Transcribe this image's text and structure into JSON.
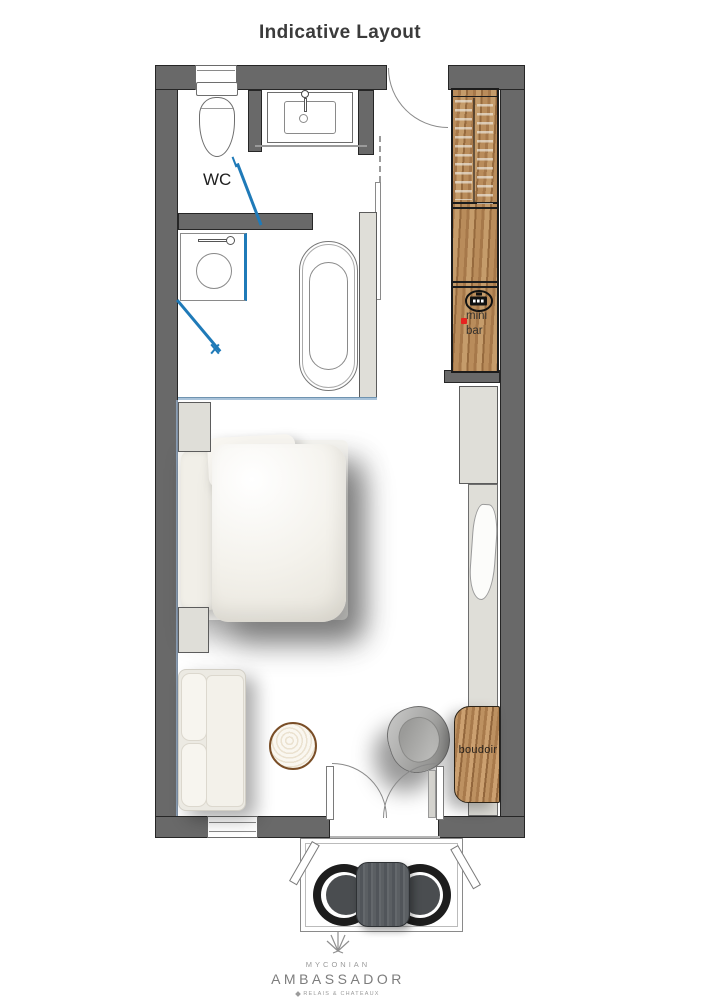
{
  "title": "Indicative Layout",
  "plan": {
    "wc_label": "WC",
    "minibar_label_line1": "mini",
    "minibar_label_line2": "bar",
    "boudoir_label": "boudoir"
  },
  "logo": {
    "name_top": "MYCONIAN",
    "name_main": "AMBASSADOR",
    "affiliation": "RELAIS & CHATEAUX"
  },
  "colors": {
    "wall_fill": "#696969",
    "wall_outline": "#262626",
    "wood": "#b08455",
    "glass_door_blue": "#1f7ab8",
    "glass_panel_blue": "#a9c3da",
    "panel_light": "#dfded8",
    "minibar_marker_red": "#e62320",
    "terrace_furniture_dark": "#1d1d1d",
    "title_text": "#3b3b3b",
    "logo_text": "#8e8e8e"
  },
  "icons": {
    "logo_mark": "sunburst-icon",
    "minibar_appliance": "espresso-machine-icon",
    "minibar_marker": "red-dot-icon",
    "affiliation_mark": "diamond-icon"
  }
}
